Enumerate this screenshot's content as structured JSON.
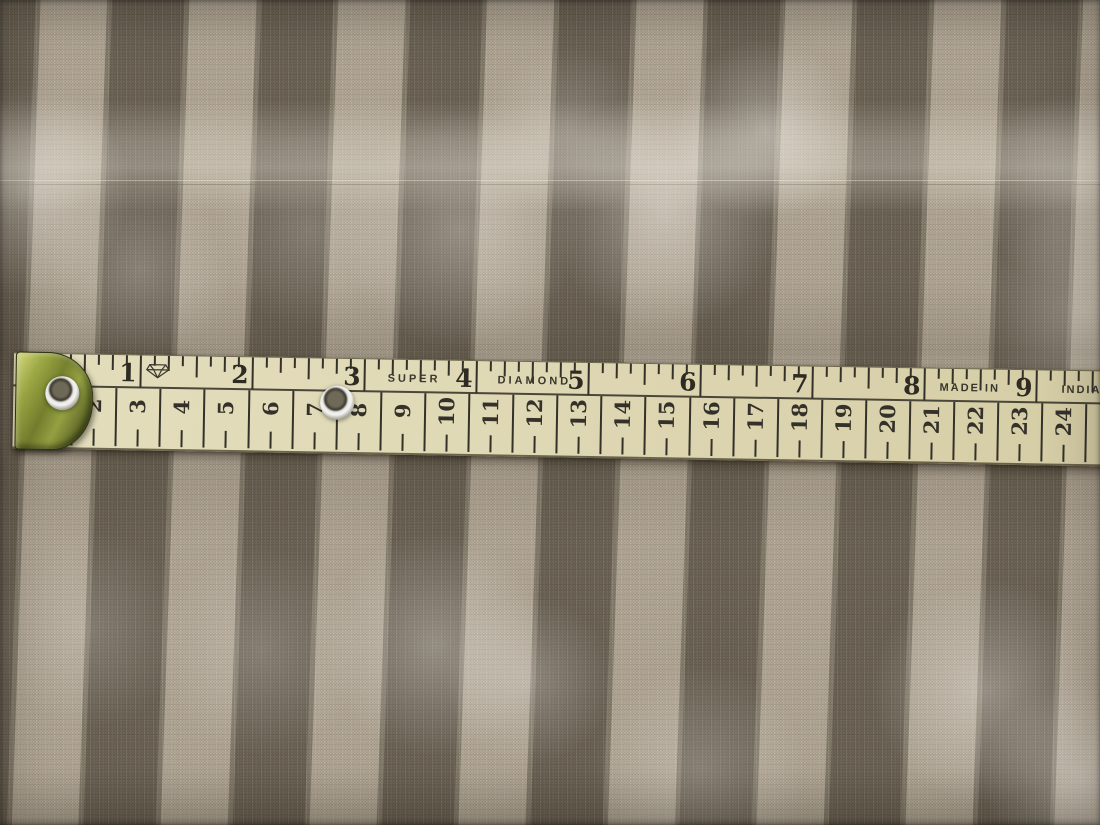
{
  "measuring_tape": {
    "inch_scale": {
      "numbers": [
        "1",
        "2",
        "3",
        "4",
        "5",
        "6",
        "7",
        "8",
        "9"
      ]
    },
    "cm_scale": {
      "numbers": [
        "2",
        "3",
        "4",
        "5",
        "6",
        "7",
        "8",
        "9",
        "10",
        "11",
        "12",
        "13",
        "14",
        "15",
        "16",
        "17",
        "18",
        "19",
        "20",
        "21",
        "22",
        "23",
        "24"
      ]
    },
    "printed_text": {
      "super": "SUPER",
      "diamond": "DIAMOND",
      "made_in": "MADE IN",
      "india": "INDIA"
    },
    "grommet_count": 2,
    "colors": {
      "tape": "#e0d9b6",
      "markings": "#33312a",
      "metal_end": "#8e9a3e",
      "grommet": "#e6e6e4",
      "underlay_strip": "#3c4a22"
    }
  },
  "fabric": {
    "pattern": "vertical satin stripes",
    "colors": {
      "dark_stripe": "#6b6254",
      "light_stripe": "#b3a897",
      "sheen_highlight": "#f4efe4"
    }
  }
}
